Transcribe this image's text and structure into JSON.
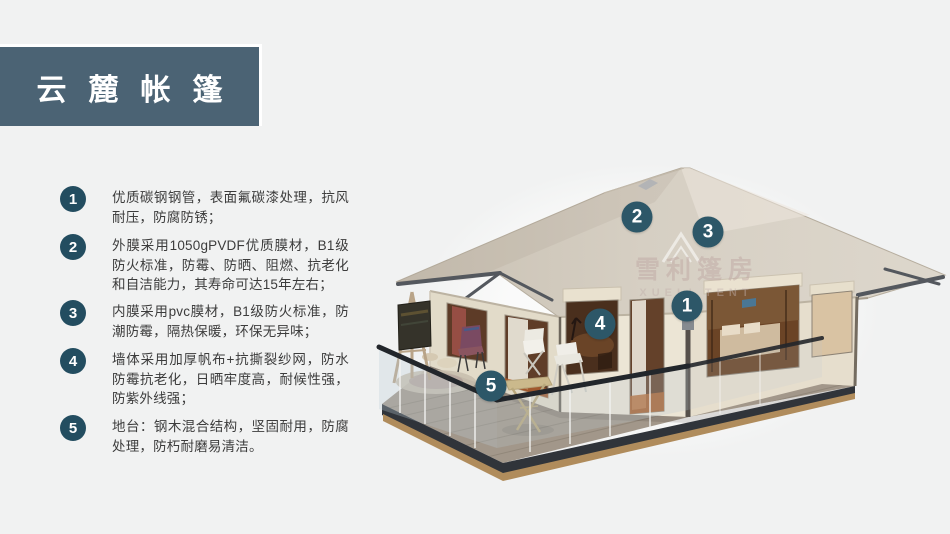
{
  "banner": {
    "title": "云麓帐篷",
    "color": "#4b6374"
  },
  "features": [
    {
      "num": "1",
      "text": "优质碳钢钢管，表面氟碳漆处理，抗风耐压，防腐防锈；"
    },
    {
      "num": "2",
      "text": "外膜采用1050gPVDF优质膜材，B1级防火标准，防霉、防晒、阻燃、抗老化和自洁能力，其寿命可达15年左右；"
    },
    {
      "num": "3",
      "text": "内膜采用pvc膜材，B1级防火标准，防潮防霉，隔热保暖，环保无异味；"
    },
    {
      "num": "4",
      "text": "墙体采用加厚帆布+抗撕裂纱网，防水防霉抗老化，日晒牢度高，耐候性强，防紫外线强；"
    },
    {
      "num": "5",
      "text": "地台：钢木混合结构，坚固耐用，防腐处理，防朽耐磨易清洁。"
    }
  ],
  "illustration": {
    "watermark": {
      "cn": "雪利篷房",
      "en": "XUELI TENT"
    },
    "callouts": [
      {
        "num": "1",
        "x": 687,
        "y": 306
      },
      {
        "num": "2",
        "x": 637,
        "y": 217
      },
      {
        "num": "3",
        "x": 708,
        "y": 232
      },
      {
        "num": "4",
        "x": 600,
        "y": 324
      },
      {
        "num": "5",
        "x": 491,
        "y": 386
      }
    ],
    "colors": {
      "badge": "#2d5768",
      "bullet": "#234d60",
      "roof": "#d5cec2",
      "wall": "#eae3d4",
      "deck": "#a2978a",
      "fascia": "#30343a"
    }
  }
}
